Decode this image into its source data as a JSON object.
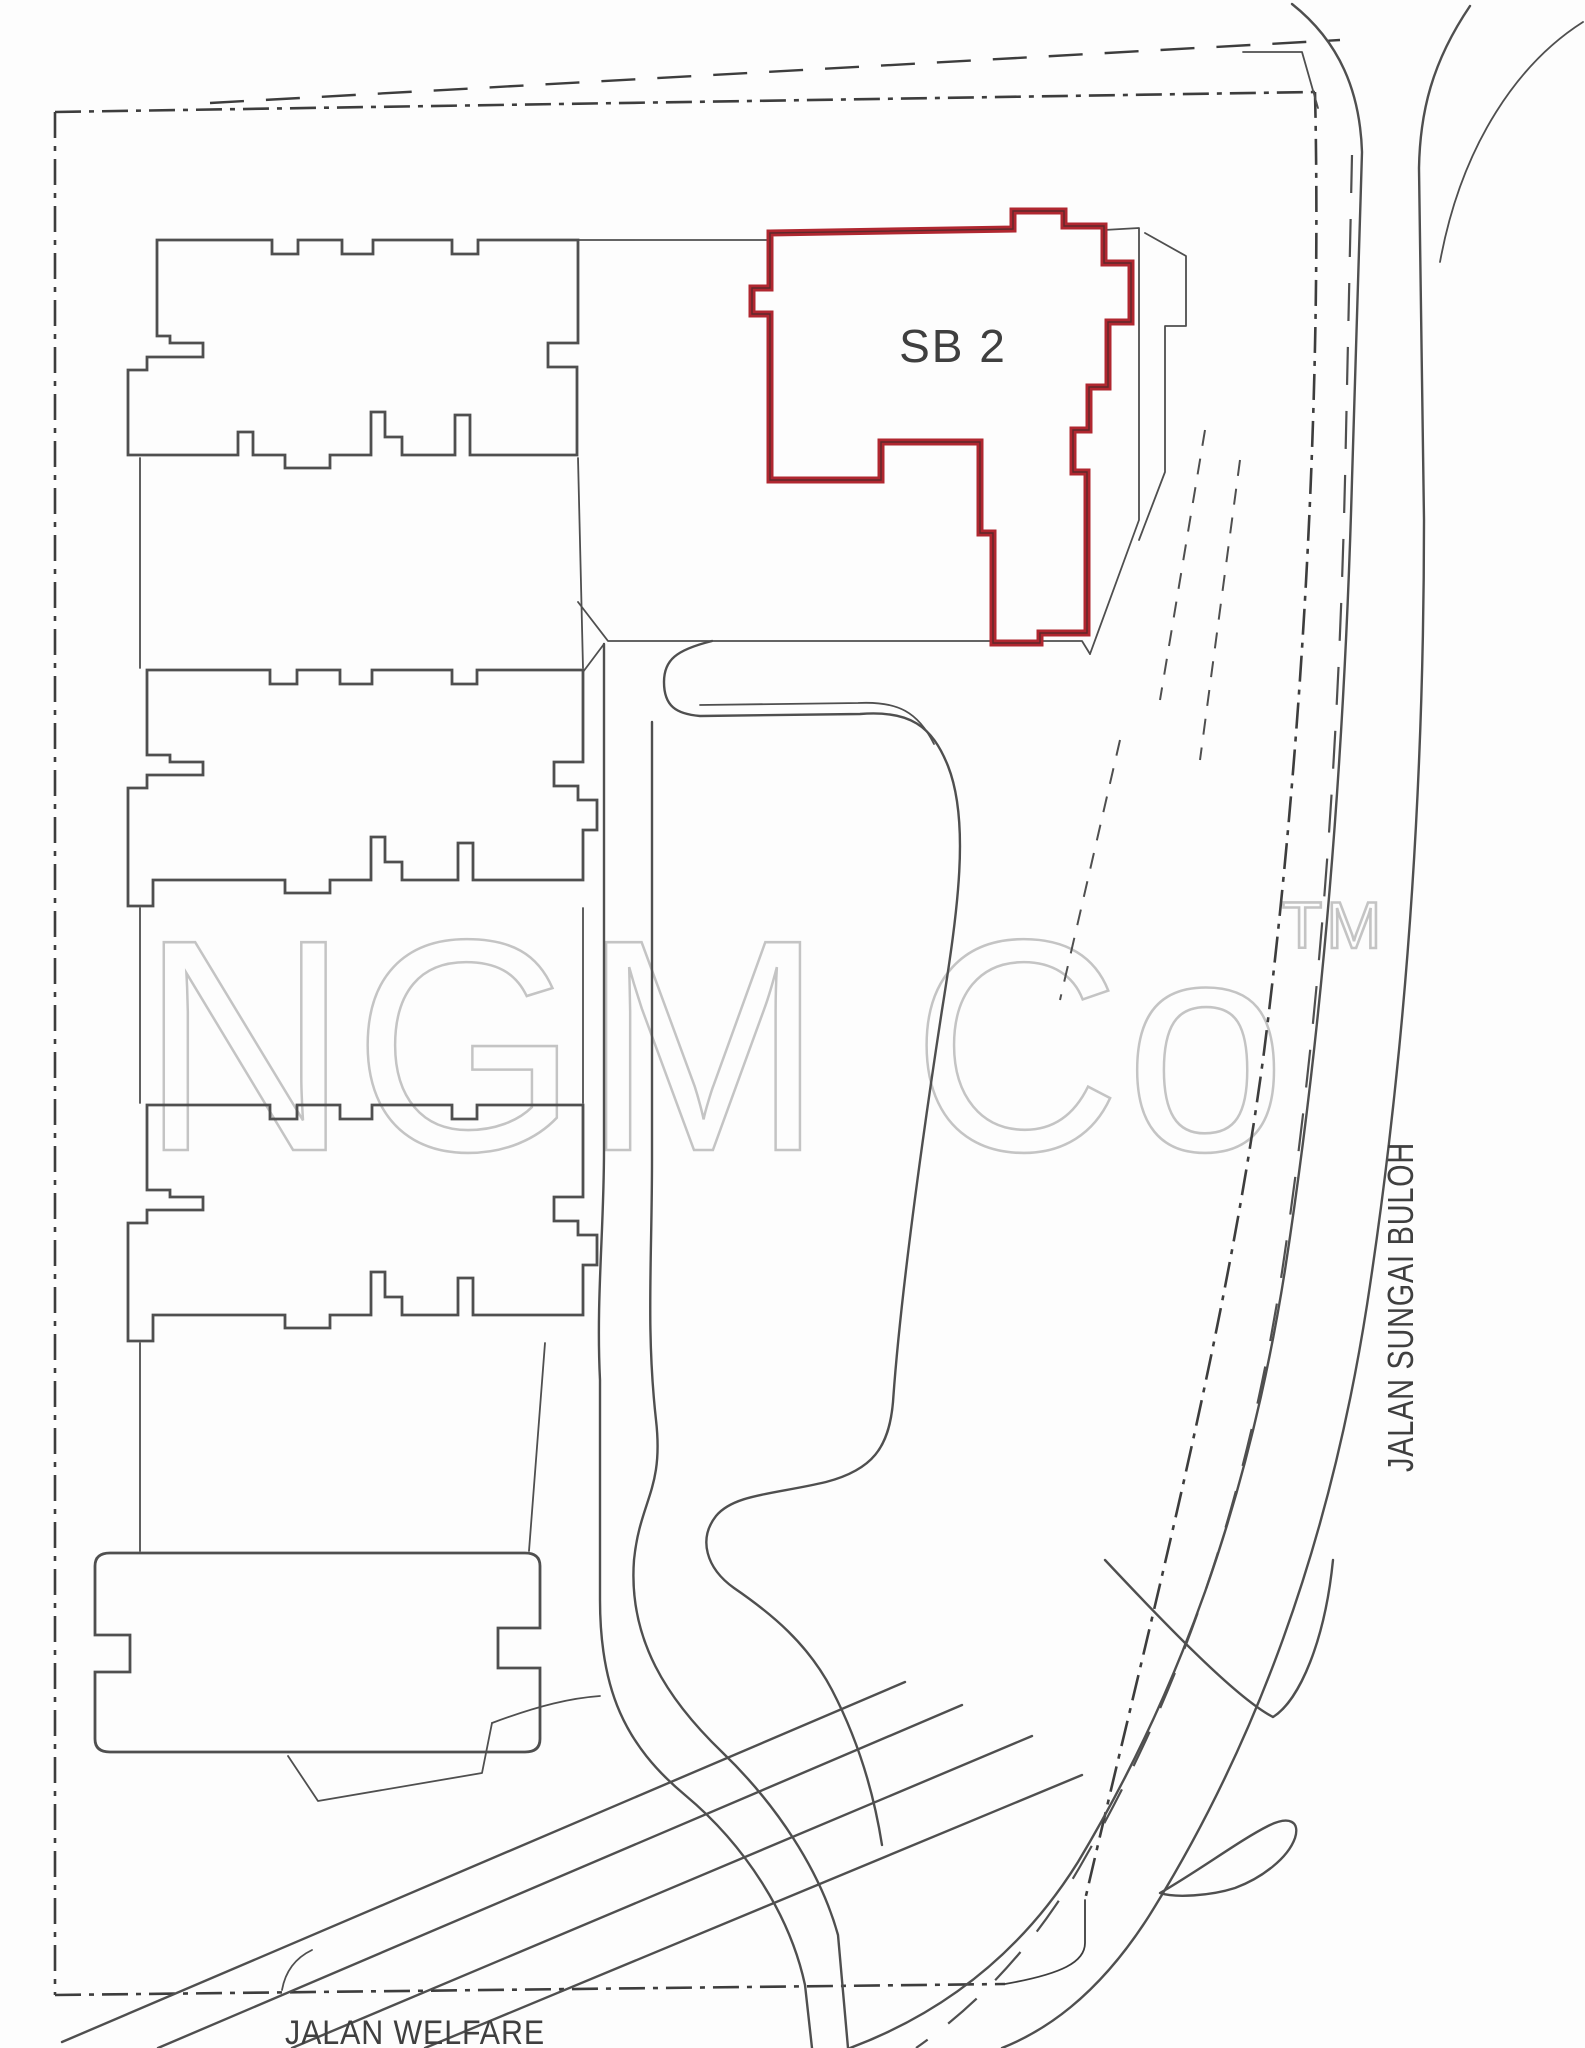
{
  "labels": {
    "unit": "SB 2",
    "road_right": "JALAN SUNGAI BULOH",
    "road_bottom": "JALAN WELFARE"
  },
  "watermark": {
    "text": "NGM Co",
    "tm": "TM"
  },
  "colors": {
    "highlight_red": "#b02730",
    "line": "#4f4f4f",
    "boundary": "#3d3d3d",
    "watermark": "#c4c4c4",
    "background": "#fdfdfd"
  }
}
